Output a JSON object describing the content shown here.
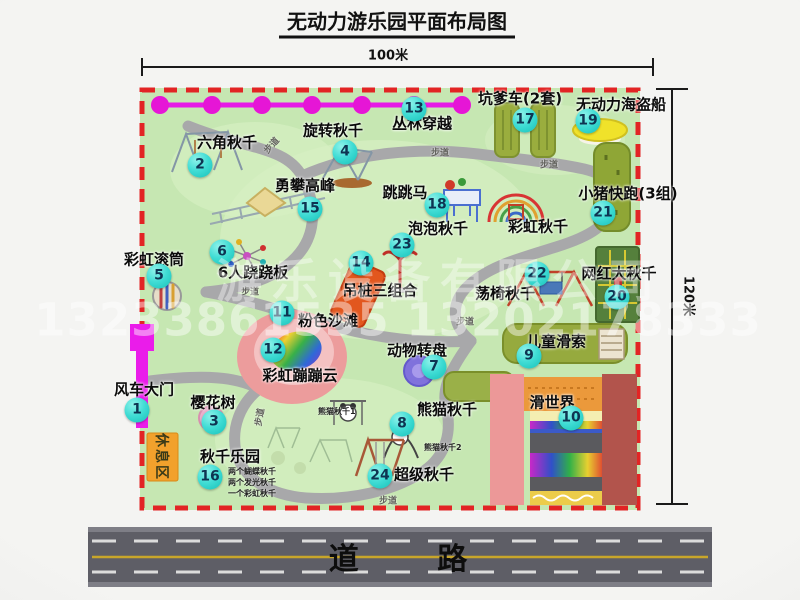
{
  "title": "无动力游乐园平面布局图",
  "dims": {
    "top": "100米",
    "right": "120米"
  },
  "road": {
    "label": "道 路"
  },
  "trail_label": "步道",
  "rest_area_label": "休息区",
  "watermark": {
    "company": "游乐设备有限公司",
    "phone": "13233861535 13202178333"
  },
  "extra": {
    "rainbow_swing": "彩虹秋千",
    "panda1": "熊猫秋千1",
    "panda2": "熊猫秋千2",
    "note1": "两个蝴蝶秋千",
    "note2": "两个发光秋千",
    "note3": "一个彩虹秋千"
  },
  "attractions": [
    {
      "num": "1",
      "label": "风车大门"
    },
    {
      "num": "2",
      "label": "六角秋千"
    },
    {
      "num": "3",
      "label": "樱花树"
    },
    {
      "num": "4",
      "label": "旋转秋千"
    },
    {
      "num": "5",
      "label": "彩虹滚筒"
    },
    {
      "num": "6",
      "label": "6人跷跷板"
    },
    {
      "num": "7",
      "label": "动物转盘"
    },
    {
      "num": "8",
      "label": "熊猫秋千"
    },
    {
      "num": "9",
      "label": "儿童滑索"
    },
    {
      "num": "10",
      "label": "滑世界"
    },
    {
      "num": "11",
      "label": "粉色沙滩"
    },
    {
      "num": "12",
      "label": "彩虹蹦蹦云"
    },
    {
      "num": "13",
      "label": "丛林穿越"
    },
    {
      "num": "14",
      "label": "吊桩三组合"
    },
    {
      "num": "15",
      "label": "勇攀高峰"
    },
    {
      "num": "16",
      "label": "秋千乐园"
    },
    {
      "num": "17",
      "label": "坑爹车(2套)"
    },
    {
      "num": "18",
      "label": "跳跳马"
    },
    {
      "num": "19",
      "label": "无动力海盗船"
    },
    {
      "num": "20",
      "label": "网红大秋千"
    },
    {
      "num": "21",
      "label": "小猪快跑(3组)"
    },
    {
      "num": "22",
      "label": "荡椅秋千"
    },
    {
      "num": "23",
      "label": "泡泡秋千"
    },
    {
      "num": "24",
      "label": "超级秋千"
    }
  ],
  "colors": {
    "map_green": "#c6e7b2",
    "path_gray": "#a8a8aa",
    "border_red": "#e22424",
    "badge_cyan": "#3fdcd4",
    "zipline_magenta": "#e61ae6",
    "road_gray": "#5e5e66"
  }
}
